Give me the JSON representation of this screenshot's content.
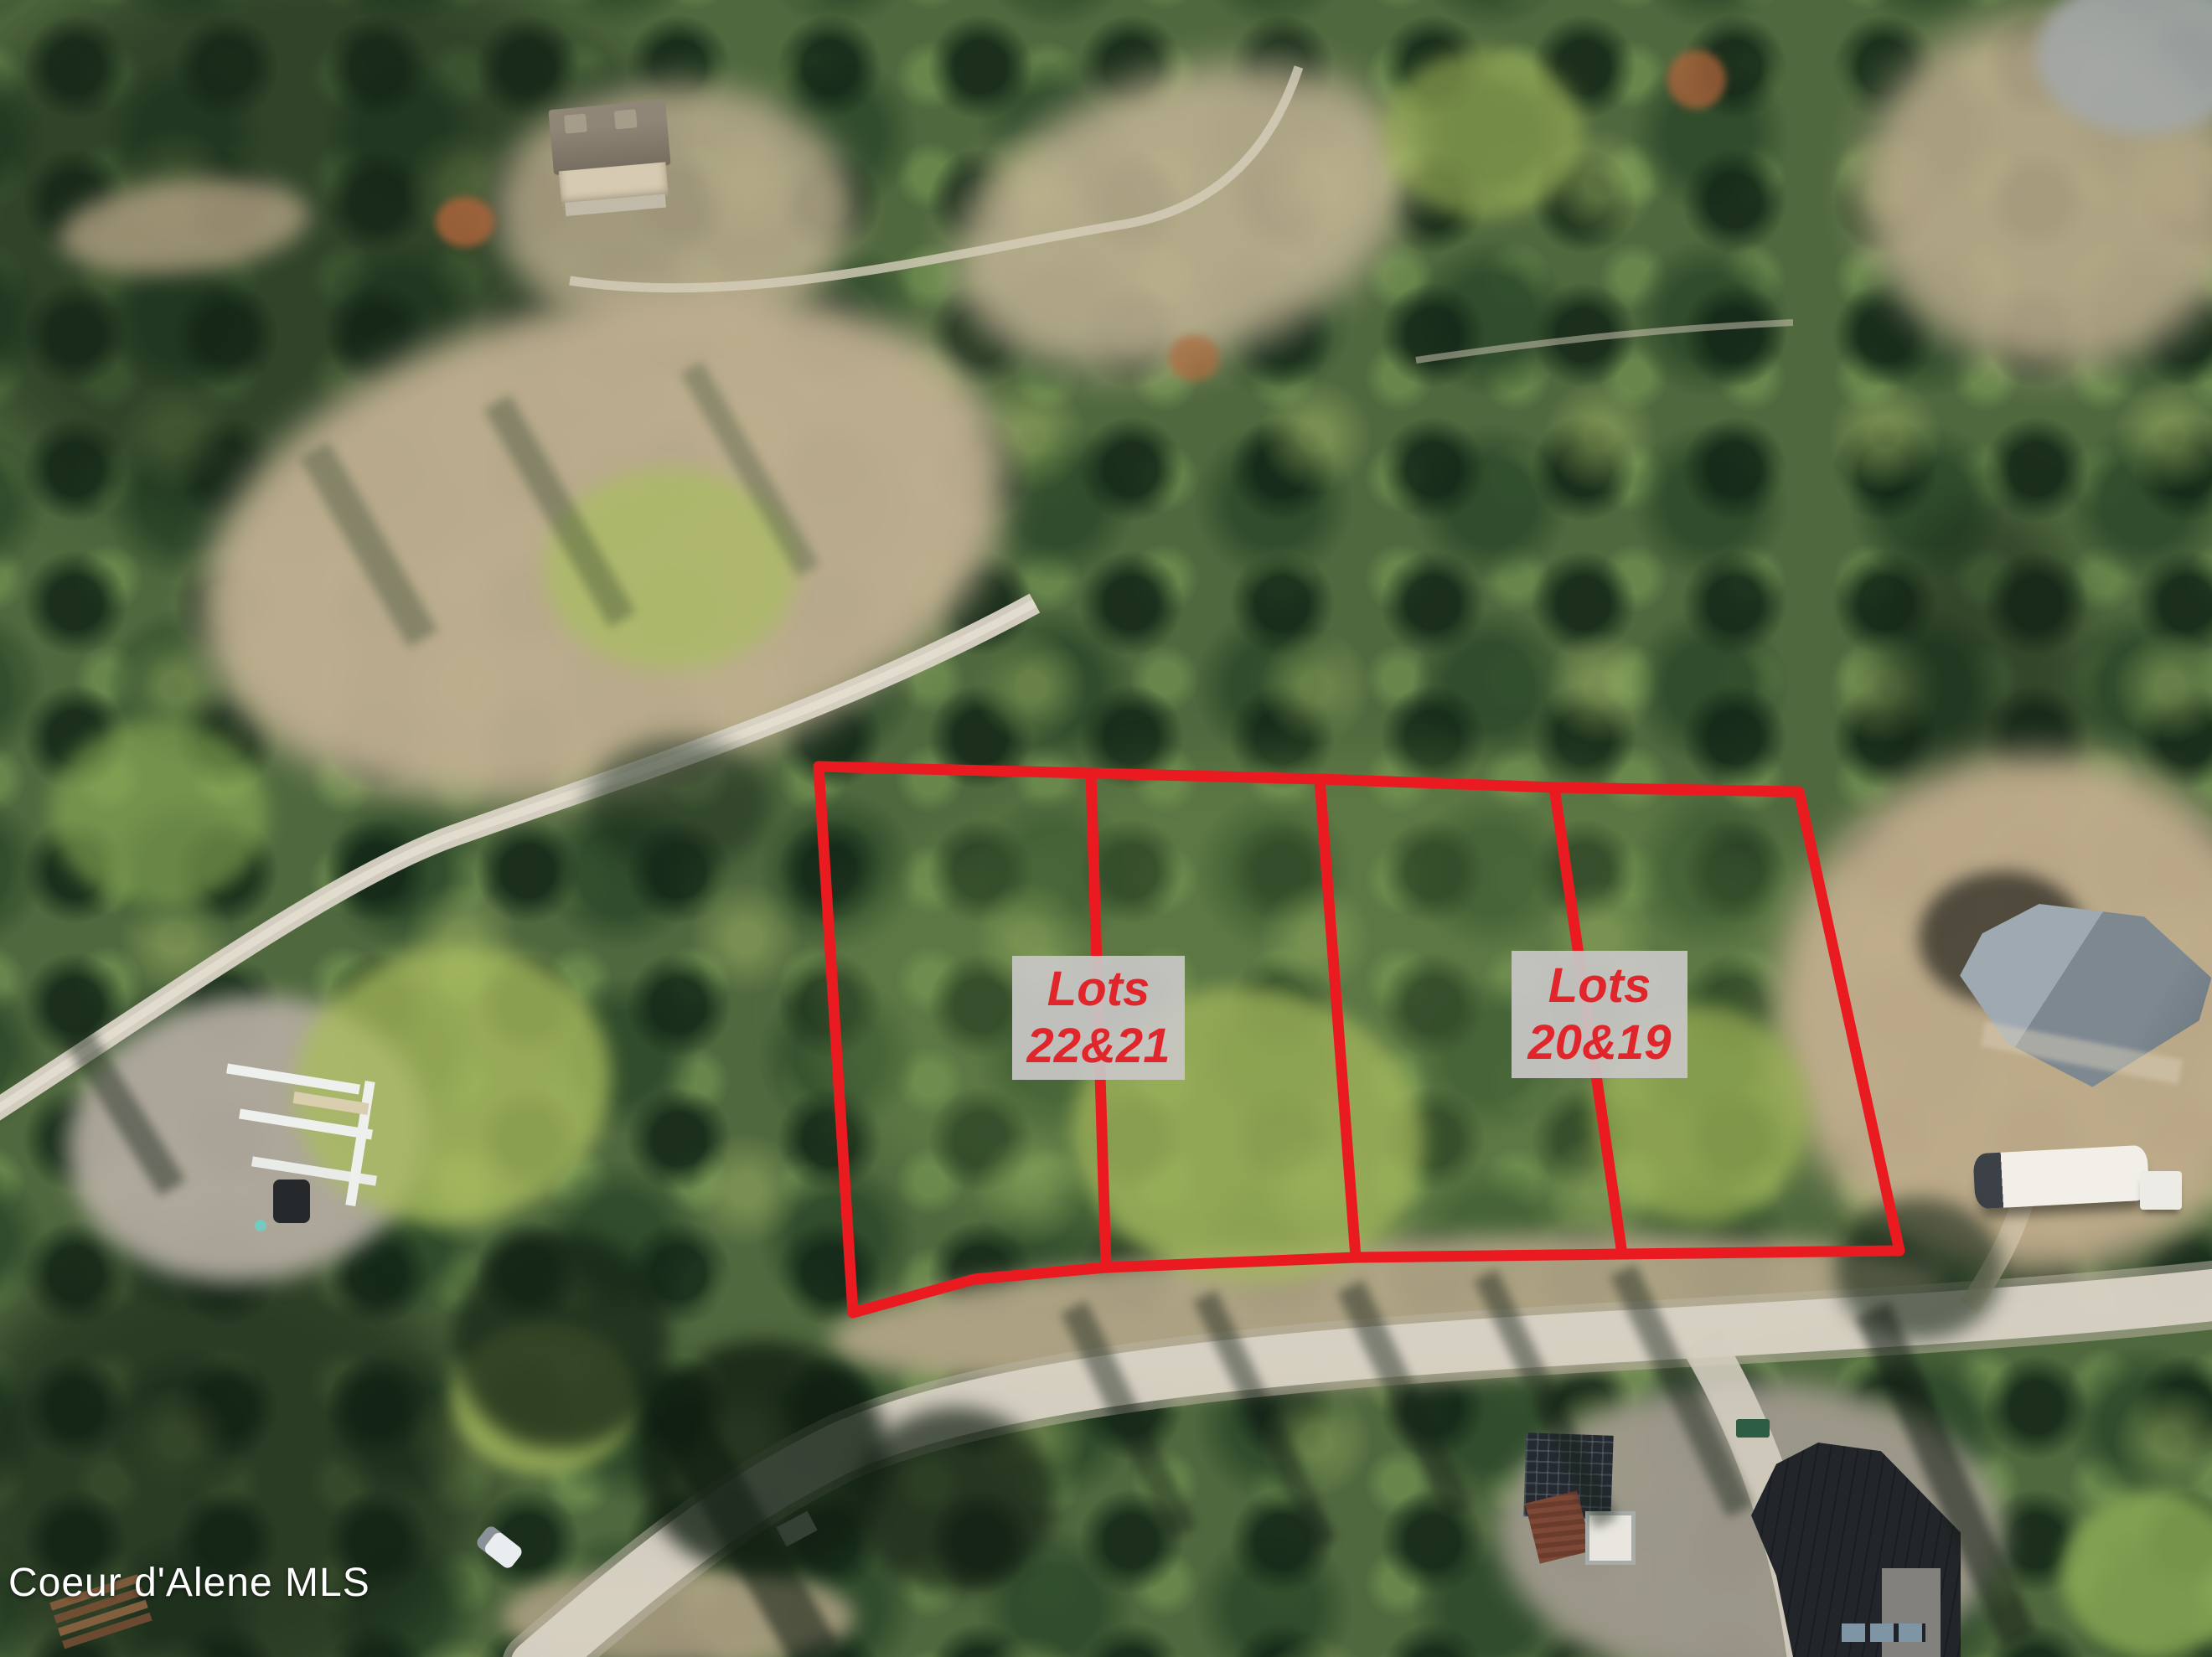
{
  "scene": {
    "description": "Aerial drone photo of forested land with outlined parcels"
  },
  "annotations": {
    "boundary_color": "#ea1b20",
    "label_box_color": "rgba(199,198,196,0.94)",
    "label_text_color": "#e0262b",
    "lot_label_left": {
      "line1": "Lots",
      "line2": "22&21"
    },
    "lot_label_right": {
      "line1": "Lots",
      "line2": "20&19"
    }
  },
  "watermark": {
    "text": "Coeur d'Alene MLS",
    "color": "#ffffff"
  }
}
